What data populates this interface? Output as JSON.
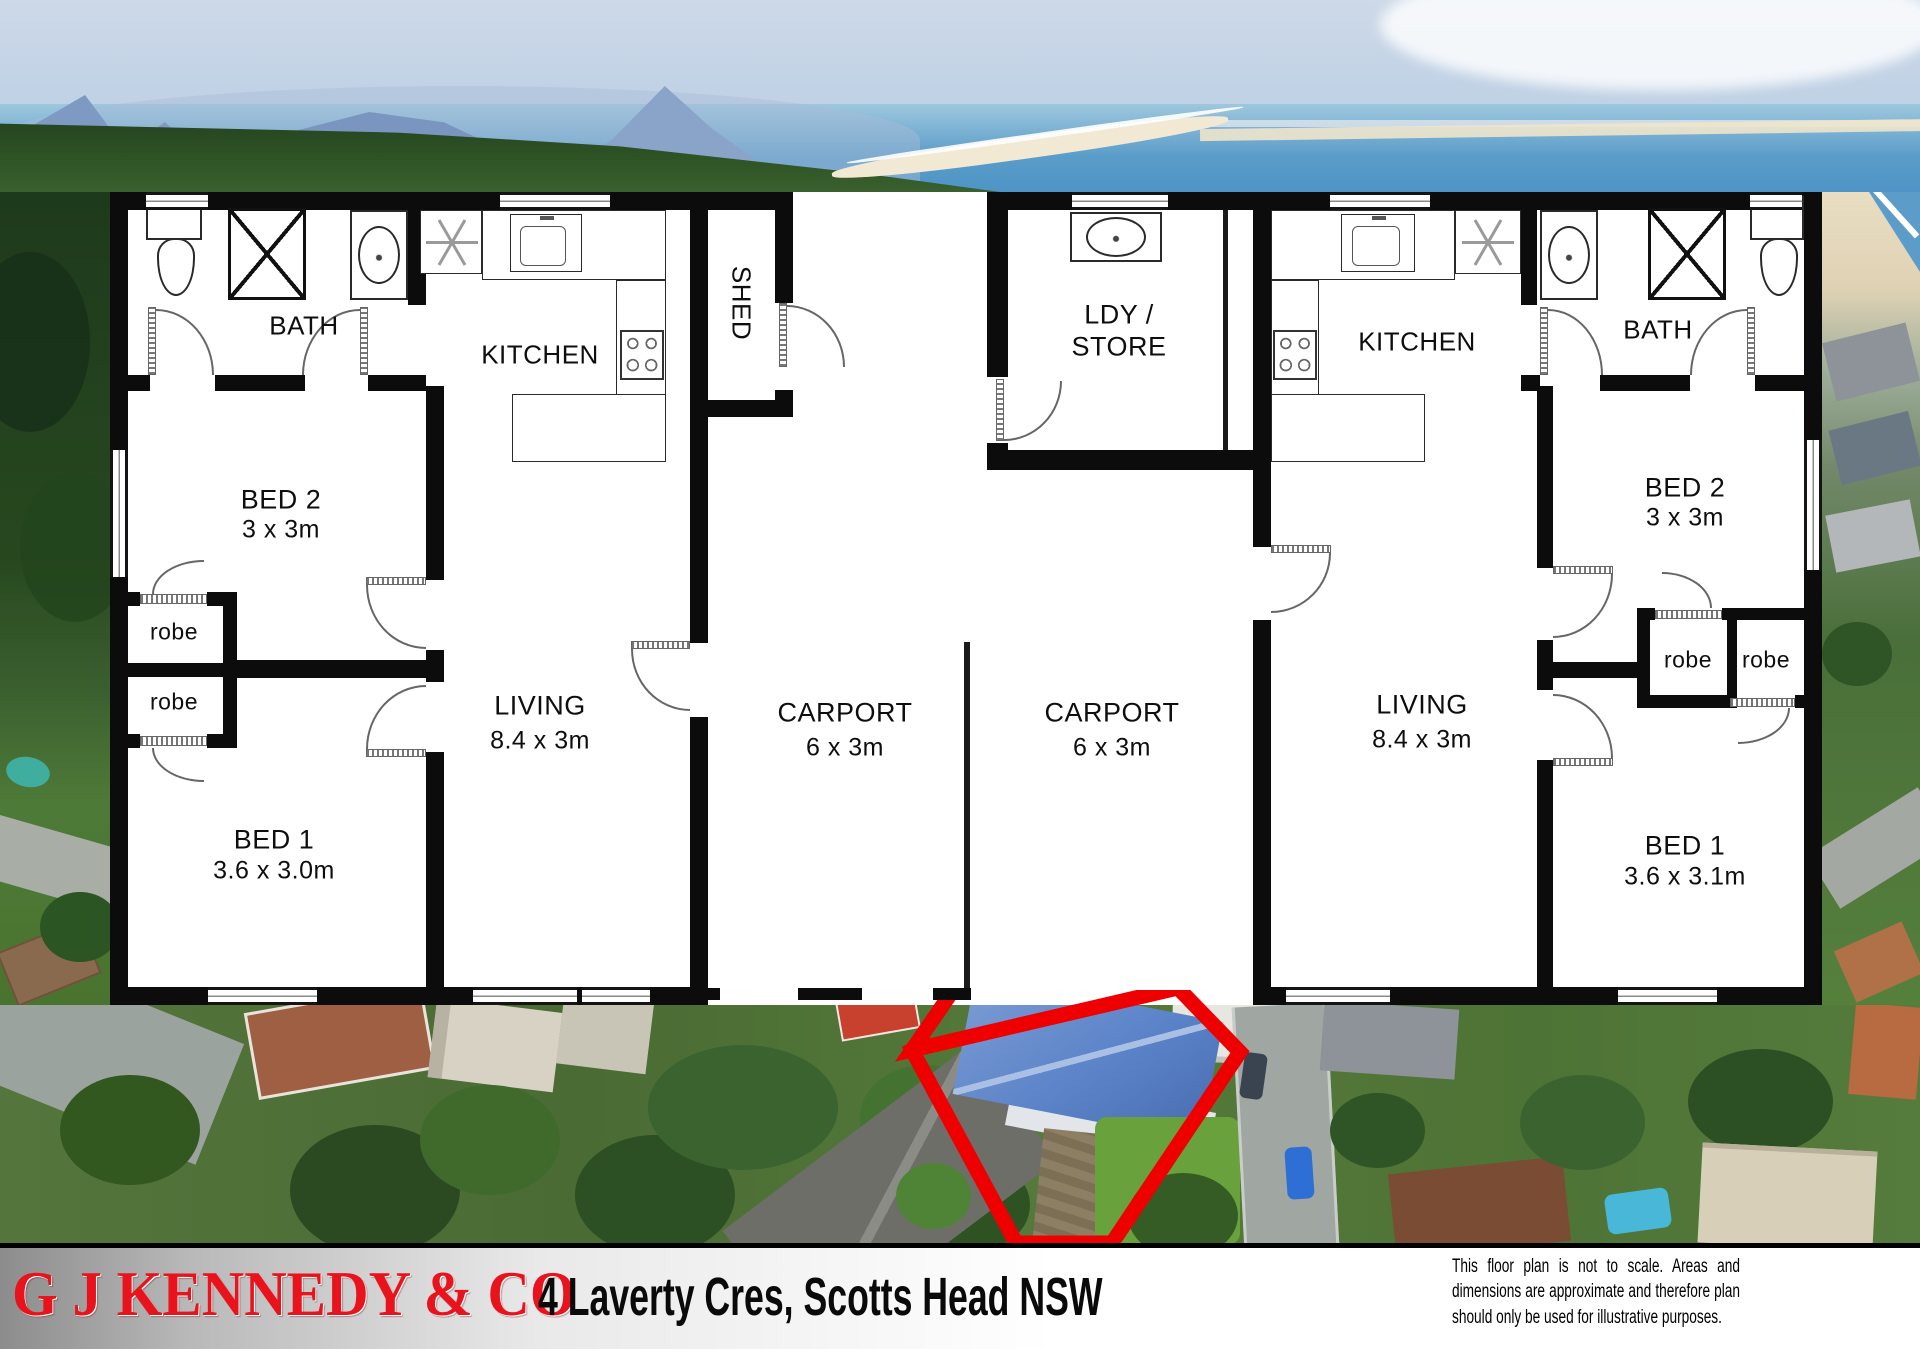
{
  "plan": {
    "left": {
      "bath": "BATH",
      "kitchen": "KITCHEN",
      "bed2": {
        "name": "BED 2",
        "dim": "3 x 3m"
      },
      "bed1": {
        "name": "BED 1",
        "dim": "3.6 x 3.0m"
      },
      "living": {
        "name": "LIVING",
        "dim": "8.4 x 3m"
      },
      "robe_top": "robe",
      "robe_bottom": "robe"
    },
    "right": {
      "bath": "BATH",
      "kitchen": "KITCHEN",
      "bed2": {
        "name": "BED 2",
        "dim": "3 x 3m"
      },
      "bed1": {
        "name": "BED 1",
        "dim": "3.6 x 3.1m"
      },
      "living": {
        "name": "LIVING",
        "dim": "8.4 x 3m"
      },
      "robe_left": "robe",
      "robe_right": "robe"
    },
    "shed": "SHED",
    "laundry": {
      "line1": "LDY /",
      "line2": "STORE"
    },
    "carport_left": {
      "name": "CARPORT",
      "dim": "6 x 3m"
    },
    "carport_right": {
      "name": "CARPORT",
      "dim": "6 x 3m"
    }
  },
  "footer": {
    "agency": "G J KENNEDY & CO",
    "address": "4 Laverty Cres, Scotts Head NSW",
    "disclaimer": "This floor plan is not to scale. Areas and dimensions are approximate and therefore plan should only be used for illustrative purposes."
  },
  "colors": {
    "wall_black": "#0c0c0c",
    "agency_red": "#e8141c",
    "boundary_red": "#ee0000",
    "roof_blue": "#5b83c8",
    "ocean_blue": "#4e94c6"
  }
}
